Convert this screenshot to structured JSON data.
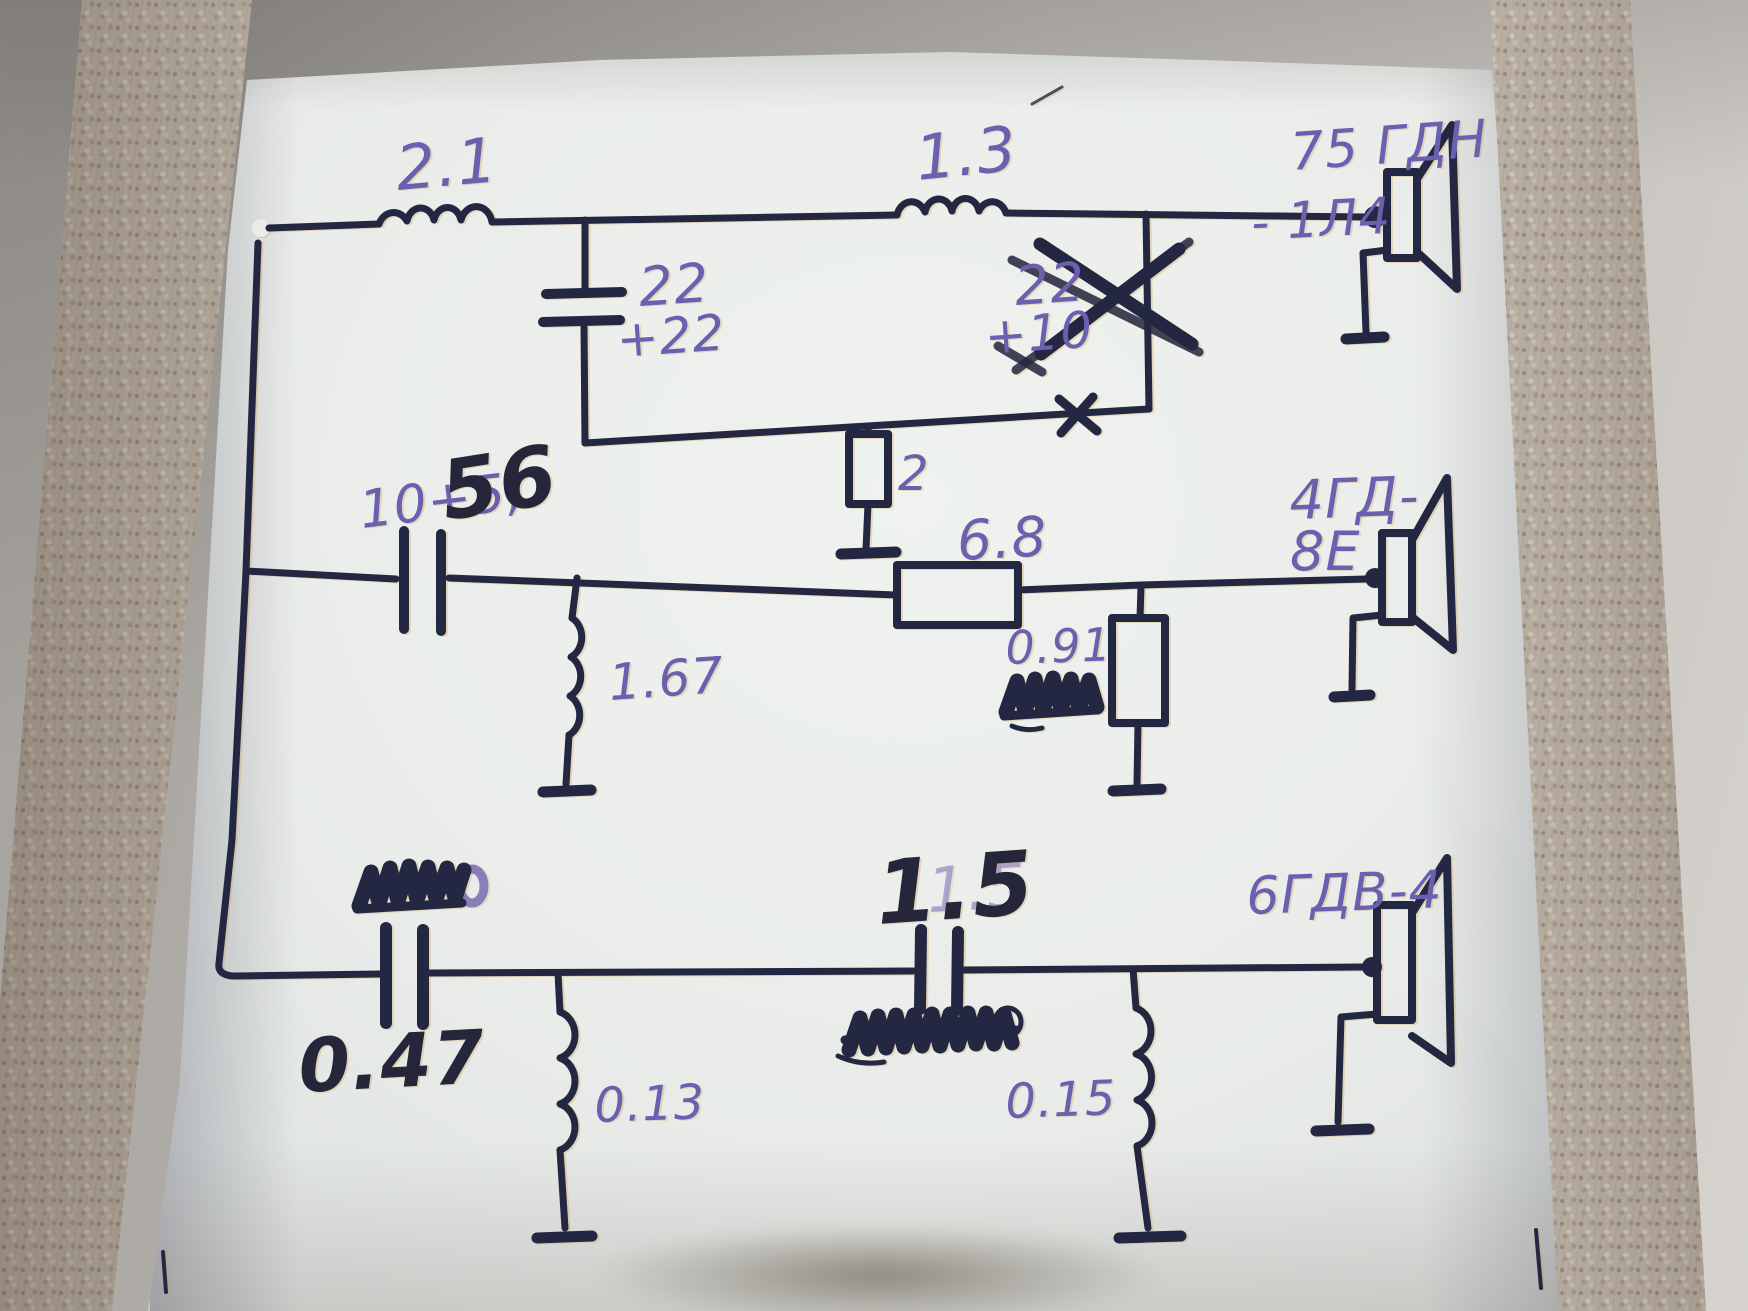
{
  "colors": {
    "ink": "#232741",
    "pen_purple": "#6b5fb0",
    "marker_dark": "#26263a",
    "strike_orange": "#c8743f",
    "green_accent": "#2f9e7a",
    "paper": "#e9ece9"
  },
  "woofer": {
    "l1": "2.1",
    "l2": "1.3",
    "c1_row1": "22",
    "c1_row2": "+22",
    "c2_row1": "22",
    "c2_row2": "+10",
    "r1": "2",
    "driver_line1": "75 ГДН",
    "driver_line2": "- 1Л4"
  },
  "midrange": {
    "cap_pen": "10+5,",
    "cap_marker": "56",
    "r_series": "6.8",
    "l_shunt": "1.67",
    "r_shunt": "0.91",
    "driver_line1": "4ГД-",
    "driver_line2": "8Е"
  },
  "tweeter": {
    "c1": "0.47",
    "c2_marker": "1.5",
    "c2_pen": "1.5",
    "l1": "0.13",
    "l2": "0.15",
    "driver": "6ГДВ-4"
  }
}
